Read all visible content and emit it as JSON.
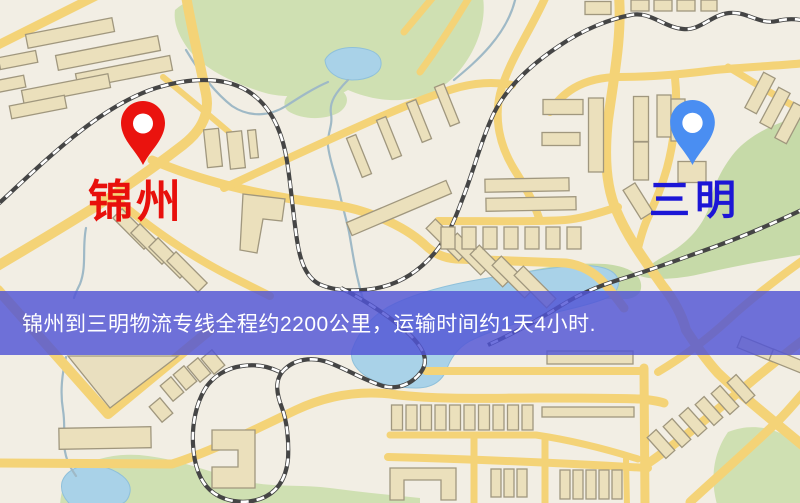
{
  "map": {
    "markers": [
      {
        "id": "origin",
        "name": "锦州",
        "pin_shape": "map-pin",
        "pin_color": "#ea130e",
        "label_color": "#e8100c"
      },
      {
        "id": "destination",
        "name": "三明",
        "pin_shape": "map-pin",
        "pin_color": "#4a8ef2",
        "label_color": "#1c16d6"
      }
    ],
    "banner": {
      "text": "锦州到三明物流专线全程约2200公里，运输时间约1天4小时.",
      "distance_km": "2200",
      "duration": "1天4小时"
    },
    "colors": {
      "land": "#f2eee4",
      "road": "#f4d377",
      "green": "#cfe0b2",
      "green2": "#c6daa8",
      "water": "#a9d2e8",
      "water_edge": "#8fc0da",
      "stream": "#9fb9c6",
      "building": "#ebe0bc",
      "building2": "#e9dfbf",
      "building_stroke": "#a0977e",
      "rail": "#454545",
      "rail_dash": "#ffffff",
      "banner_bg": "rgba(80,84,214,0.82)",
      "banner_text": "#ffffff",
      "origin_pin": "#ea130e",
      "origin_label": "#e8100c",
      "dest_pin": "#4a8ef2",
      "dest_label": "#1c16d6"
    }
  }
}
